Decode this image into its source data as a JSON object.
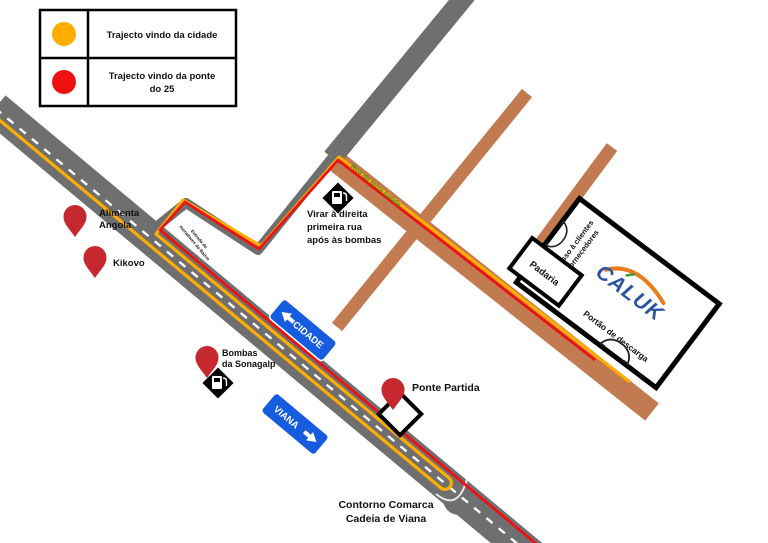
{
  "legend": {
    "item1": {
      "label": "Trajecto vindo da cidade"
    },
    "item2": {
      "label_line1": "Trajecto vindo da ponte",
      "label_line2": "do 25"
    }
  },
  "colors": {
    "route_city_yellow": "#FFAD00",
    "route_bridge_red": "#EE1111",
    "road_gray": "#6F6F6F",
    "dirt_road_brown": "#C27B51",
    "sign_blue": "#155CDE",
    "pin_red": "#C5282E",
    "logo_blue": "#2A55A5",
    "logo_orange": "#E87D1E",
    "logo_accent_green": "#3C9B35",
    "street_label_green": "#4C8B28"
  },
  "pins": {
    "alimenta": {
      "line1": "Alimenta",
      "line2": "Angola"
    },
    "kikovo": {
      "label": "Kikovo"
    },
    "bombas": {
      "line1": "Bombas",
      "line2": "da Sonagalp"
    },
    "ponte_partida": {
      "label": "Ponte Partida"
    }
  },
  "signs": {
    "cidade": "CIDADE",
    "viana": "VIANA"
  },
  "streets": {
    "terra_batida": "Rua de terra batida",
    "estrada_line1": "Estrada de",
    "estrada_line2": "moradores do Bairro",
    "contorno_line1": "Contorno Comarca",
    "contorno_line2": "Cadeia de Viana"
  },
  "instructions": {
    "line1": "Virar à direita",
    "line2": "primeira rua",
    "line3": "após às bombas"
  },
  "building": {
    "logo": "CALUK",
    "padaria": "Padaria",
    "portao": "Portão de descarga",
    "acesso_line1": "Acesso à clientes",
    "acesso_line2": "e fornecedores"
  }
}
